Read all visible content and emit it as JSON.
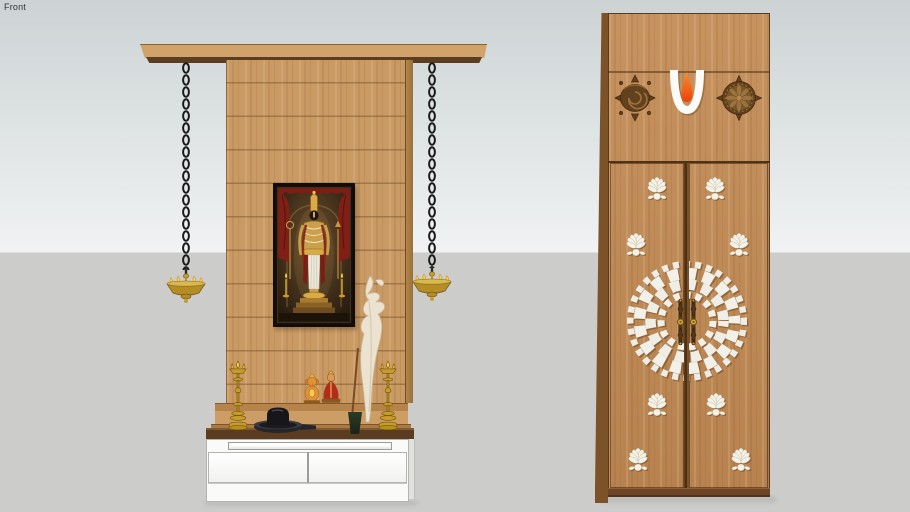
{
  "app": {
    "view_label": "Front"
  },
  "background": {
    "sky_top_color": "#cdd3d4",
    "sky_horizon_color": "#f0f2f3",
    "ground_color": "#cccccb"
  },
  "palette": {
    "wood_light": "#d2a26b",
    "wood_mid": "#c69560",
    "wood_underside_dark": "#5d3d21",
    "counter_wood": "#5c3c20",
    "cabinet_white": "#fafaf9",
    "brass_gold": "#c79d2a",
    "flame_yellow": "#ffd23e",
    "chain_black": "#1b1b1b",
    "namam_white": "#fcfbf7",
    "namam_orange": "#ee5a10",
    "carving_bronze": "#63411d",
    "mirror_white": "#f1f1ea",
    "curtain_red": "#801f15",
    "picture_frame_black": "#181109"
  },
  "left_unit": {
    "name": "pooja mandir unit",
    "components": [
      {
        "id": "wood-canopy",
        "label": "canopy shelf"
      },
      {
        "id": "wood-back-panel",
        "label": "slatted back panel"
      },
      {
        "id": "hanging-chain-left",
        "label": "hanging chain"
      },
      {
        "id": "hanging-chain-right",
        "label": "hanging chain"
      },
      {
        "id": "hanging-diya-left",
        "label": "hanging brass diya"
      },
      {
        "id": "hanging-diya-right",
        "label": "hanging brass diya"
      },
      {
        "id": "deity-picture",
        "label": "Lord Venkateswara framed picture"
      },
      {
        "id": "ivory-sculpture",
        "label": "decorative ivory sculpture"
      },
      {
        "id": "incense-stick",
        "label": "incense stick in pot"
      },
      {
        "id": "brass-samai-left",
        "label": "brass oil lamp"
      },
      {
        "id": "brass-samai-right",
        "label": "brass oil lamp"
      },
      {
        "id": "ganesha-idol",
        "label": "Ganesha idol"
      },
      {
        "id": "lakshmi-idol",
        "label": "Lakshmi idol"
      },
      {
        "id": "shiva-lingam",
        "label": "Shiva lingam"
      },
      {
        "id": "base-cabinet",
        "label": "white base cabinet",
        "drawer_count": 2,
        "tray_count": 1
      }
    ]
  },
  "right_unit": {
    "name": "pooja room double door",
    "symbols": [
      {
        "id": "shankha-carving",
        "label": "conch carving"
      },
      {
        "id": "namam-tilak",
        "label": "Vaishnava namam tilak"
      },
      {
        "id": "chakra-carving",
        "label": "chakra carving"
      }
    ],
    "doors": {
      "count": 2,
      "lotus_cutouts": 8,
      "center_motif": "mirror mosaic mandala",
      "handle_count": 2
    }
  }
}
